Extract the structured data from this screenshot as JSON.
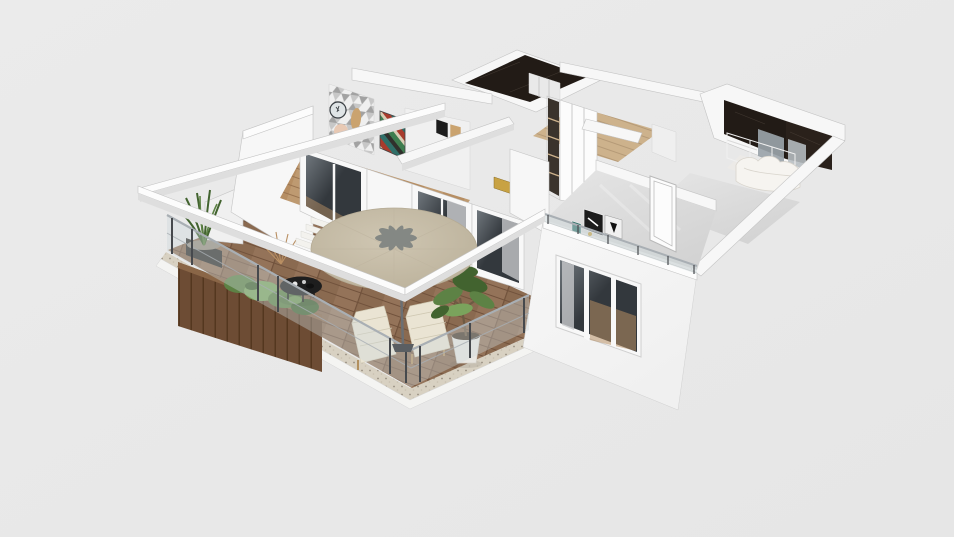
{
  "scene": {
    "viewport_label": "3D floor plan isometric cutaway render",
    "background": "#eaeaea"
  },
  "objects": [
    "terrace-deck",
    "pebble-slab-border",
    "slab-edge",
    "glass-railing",
    "wood-planter",
    "grass-plant",
    "planter-shrubs",
    "tall-plant",
    "dried-branches",
    "coffee-table",
    "white-steps",
    "sun-lounger",
    "potted-tree",
    "patio-umbrella",
    "umbrella-leaf-motif",
    "pergola-beam",
    "living-room-wood-floor",
    "sliding-glass-door",
    "dining-chair",
    "triangle-mosaic-wall",
    "wall-clock",
    "peach-wall-decor",
    "striped-artwork",
    "small-wall-frames",
    "hallway-wardrobe",
    "open-shelf-unit",
    "corridor-wood-floor",
    "corridor-beam",
    "gold-decor",
    "dark-marble-bathroom",
    "bathroom-vanity",
    "shower-glass",
    "towel-bar",
    "white-marble-floor",
    "bedroom-wardrobe",
    "white-bed",
    "gloss-bedroom-floor",
    "bedroom-door",
    "leaning-posters",
    "balcony-railing",
    "exterior-facade",
    "facade-window",
    "window-curtain"
  ],
  "palette": {
    "background": "#ebebeb",
    "bg_edge": "#e6e6e6",
    "wall_white": "#f7f7f7",
    "wall_top": "#fcfcfc",
    "wall_light": "#f0f0f0",
    "wall_shade": "#dedede",
    "dark_marble": "#221b16",
    "dark_marble_2": "#2a211b",
    "shower_glass": "#9aa3a9",
    "shower_glass_light": "#b7bec3",
    "white_marble": "#eceae7",
    "wardrobe_gray": "#b9bcbe",
    "bed_white": "#f6f4f0",
    "bed_shadow": "#d8d4cc",
    "floor_gray": "#d3d3d3",
    "floor_gray_light": "#e5e5e5",
    "frame_white": "#f8f8f8",
    "glass_dark": "#33383d",
    "glass_reflect": "#70777d",
    "curtain_gray": "#c6c7c9",
    "interior_wood": "#b68e63",
    "interior_wood_dark": "#9a7450",
    "corridor_wood": "#cdb28c",
    "corridor_wood_dark": "#b59a77",
    "deck_wood": "#8a6a50",
    "deck_wood_dark": "#71523c",
    "deck_wood_light": "#9f7f63",
    "slab_concrete": "#d8d1c2",
    "slab_white": "#f4f4f2",
    "gravel": "#978d7f",
    "gravel_light": "#c7bfae",
    "planter_wood": "#6d4c34",
    "planter_wood_dark": "#54371f",
    "planter_wood_light": "#8a6647",
    "foliage": "#5d8245",
    "foliage_dark": "#42632f",
    "foliage_light": "#7aa35c",
    "trunk": "#6e5a43",
    "pot_white": "#e9e7e2",
    "pot_black": "#2e2c29",
    "steps_white": "#f3f2ee",
    "lounger_cushion": "#eae4d3",
    "lounger_frame": "#b2905f",
    "table_black": "#1e1e1e",
    "railing_metal": "#a9afb4",
    "railing_post": "#46494d",
    "railing_glass": "#cdd8da",
    "umbrella_canopy": "#cfc6b2",
    "umbrella_edge": "#b9af98",
    "leaf_motif": "#7d8280",
    "mosaic_light": "#efefef",
    "mosaic_mid": "#c7c7c7",
    "mosaic_dark": "#a2a2a2",
    "clock_face": "#dfe4e6",
    "clock_rim": "#3a3f44",
    "peach_circle": "#e8c9b4",
    "wood_figure": "#caa36f",
    "art_red": "#a93b2c",
    "art_green": "#3e7d4f",
    "art_teal": "#2f6f68",
    "art_cream": "#d8cdb4",
    "art_dark": "#30302c",
    "gold_decor": "#c8a243",
    "shelf_dark": "#3a332c",
    "chair_black": "#242424",
    "poster_dark": "#1c1c1c",
    "poster_light": "#f0f0f0"
  }
}
